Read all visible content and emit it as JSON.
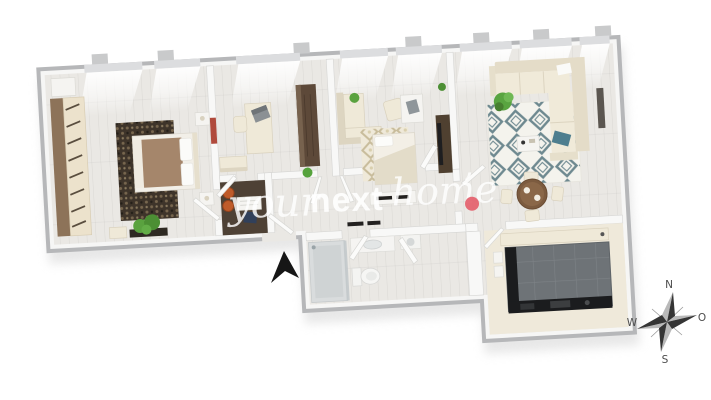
{
  "meta": {
    "image_type": "3d-floor-plan-rendering",
    "rooms": [
      "master-bedroom",
      "office",
      "kids-room",
      "living-room",
      "hallway",
      "bathroom",
      "kitchen"
    ]
  },
  "watermark": {
    "part1": "your",
    "part2": "next",
    "part3": "home",
    "apostrophe": "’",
    "dot_color": "#e4606d"
  },
  "compass": {
    "north": "N",
    "east": "O",
    "south": "S",
    "west": "W"
  },
  "icons": {
    "entrance_arrow": "black cursor-style arrow pointing to apartment entrance",
    "compass_rose": "four-point star compass"
  },
  "colors": {
    "background": "#ffffff",
    "wall_side": "#b6b7b9",
    "wall_top": "#f6f6f5",
    "floor": "#eae8e4",
    "kitchen_tile": "#6e7377",
    "counter_dark": "#1b1c1e",
    "wood_brown": "#8d7359",
    "dark_wood": "#5d4939",
    "cream_furniture": "#efe9d8",
    "rug_dark": "#3e342a",
    "rug_beige_accent": "#c8bc9b",
    "rug_teal_accent": "#6e8990",
    "teal_cushion": "#4e7e8e",
    "plant_green": "#57a23d",
    "watermark_dot": "#e4606d",
    "compass_dark": "#353535"
  }
}
